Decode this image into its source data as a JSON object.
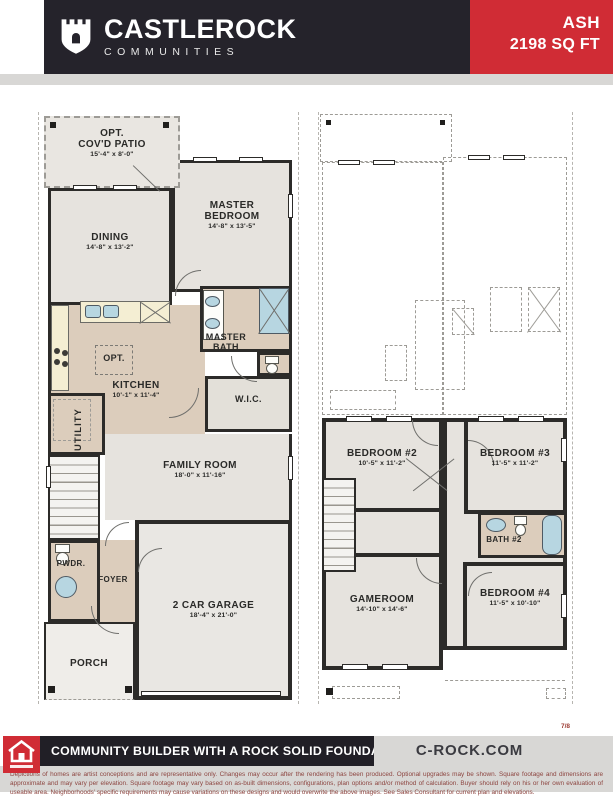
{
  "header": {
    "brand": "CASTLEROCK",
    "brand_sub": "COMMUNITIES",
    "plan_name": "ASH",
    "plan_sqft": "2198 SQ FT"
  },
  "colors": {
    "brand_red": "#d02c35",
    "charcoal": "#25232b",
    "plan_tan": "#dccdbc",
    "plan_gray": "#e6e3de",
    "fixture_blue": "#b7d6e1",
    "disclaimer_text": "#8d4540"
  },
  "floor1": {
    "patio": {
      "line1": "OPT.",
      "line2": "COV'D PATIO",
      "dims": "15'-4\" x 8'-0\""
    },
    "master_bedroom": {
      "name": "MASTER BEDROOM",
      "dims": "14'-8\" x 13'-5\""
    },
    "dining": {
      "name": "DINING",
      "dims": "14'-8\" x 13'-2\""
    },
    "kitchen": {
      "name": "KITCHEN",
      "dims": "10'-1\" x 11'-4\""
    },
    "island": {
      "name": "OPT."
    },
    "master_bath": {
      "name": "MASTER BATH"
    },
    "wic": {
      "name": "W.I.C."
    },
    "utility": {
      "name": "UTILITY"
    },
    "family_room": {
      "name": "FAMILY ROOM",
      "dims": "18'-0\" x 11'-16\""
    },
    "powder": {
      "name": "PWDR."
    },
    "foyer": {
      "name": "FOYER"
    },
    "garage": {
      "name": "2 CAR GARAGE",
      "dims": "18'-4\" x 21'-0\""
    },
    "porch": {
      "name": "PORCH"
    }
  },
  "floor2": {
    "bedroom2": {
      "name": "BEDROOM #2",
      "dims": "10'-5\" x 11'-2\""
    },
    "bedroom3": {
      "name": "BEDROOM #3",
      "dims": "11'-5\" x 11'-2\""
    },
    "bath2": {
      "name": "BATH #2"
    },
    "gameroom": {
      "name": "GAMEROOM",
      "dims": "14'-10\" x 14'-6\""
    },
    "bedroom4": {
      "name": "BEDROOM #4",
      "dims": "11'-5\" x 10'-10\""
    }
  },
  "footer": {
    "tagline": "COMMUNITY BUILDER WITH A ROCK SOLID FOUNDATION",
    "website": "C-ROCK.COM",
    "page_number": "7/8",
    "disclaimer": "Depictions of homes are artist conceptions and are representative only. Changes may occur after the rendering has been produced. Optional upgrades may be shown. Square footage and dimensions are approximate and may vary per elevation. Square footage may vary based on as-built dimensions, configurations, plan options and/or method of calculation. Buyer should rely on his or her own evaluation of useable area. Neighborhoods' specific requirements may cause variations on these designs and would overwrite the above images. See Sales Consultant for current plan and elevations."
  }
}
